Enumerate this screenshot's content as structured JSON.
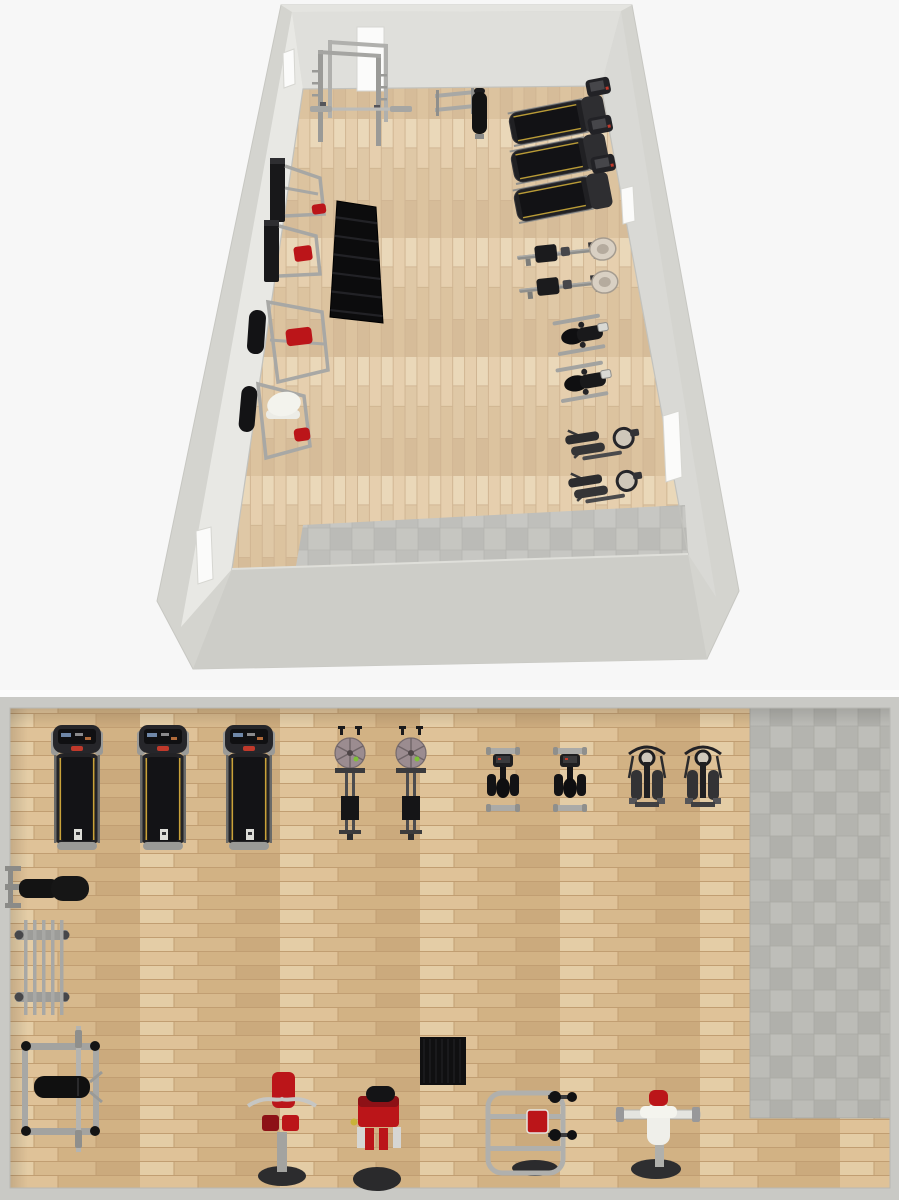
{
  "meta": {
    "title": "Gym floor plan - 3D perspective view and 2D top-down plan"
  },
  "palette": {
    "bg": "#f7f7f7",
    "wall_outer": "#d4d4cf",
    "wall_top": "#e4e4e0",
    "wall_back": "#dfdfdb",
    "wall_left": "#e8e8e4",
    "wall_right": "#d9d9d5",
    "wall_front": "#cdcdc8",
    "plan_wall": "#c9c9c5",
    "plan_gap": "#fbfbfb",
    "wood_base": "#d8b98c",
    "wood_seg1": "#dfc298",
    "wood_seg2": "#d2b284",
    "wood_seg3": "#e4cda6",
    "wood_seg4": "#d7b98d",
    "wood_seg5": "#cbaa7d",
    "wood_seam": "#c19e72",
    "tile_base": "#b6b6b1",
    "tile_a": "#bcbcb7",
    "tile_b": "#b0b0ab",
    "tile_c": "#b4b4af",
    "tile_d": "#bebeb9",
    "tile_line": "#a9a9a4",
    "equip_black": "#141416",
    "equip_dark": "#26262a",
    "equip_gray": "#9a9a97",
    "equip_lightgray": "#ababa8",
    "rail_dark": "#6b6b69",
    "red": "#bb1519",
    "red_dark": "#8d1116",
    "stop_red": "#c0392b",
    "yellow": "#c9a23a",
    "green": "#7fbf3a",
    "screen": "#3a3a3c",
    "white_part": "#efefea",
    "flywheel": "#9b8c90",
    "flywheel_rim": "#756a6d",
    "base_dark": "#2c2c2e",
    "door_white": "#fbfbfa"
  },
  "inventory": [
    {
      "label": "Treadmill",
      "count": 3
    },
    {
      "label": "Rowing machine",
      "count": 2
    },
    {
      "label": "Upright exercise bike",
      "count": 2
    },
    {
      "label": "Elliptical cross-trainer",
      "count": 2
    },
    {
      "label": "Power rack with barbell",
      "count": 1
    },
    {
      "label": "Barbell storage rack",
      "count": 1
    },
    {
      "label": "Adjustable bench",
      "count": 1
    },
    {
      "label": "Bench press station",
      "count": 1
    },
    {
      "label": "Dumbbell rack",
      "count": 1
    },
    {
      "label": "Rubber mat",
      "count": 1
    },
    {
      "label": "Preacher curl machine",
      "count": 1
    },
    {
      "label": "Red leg machine",
      "count": 1
    },
    {
      "label": "Seated press machine",
      "count": 1
    },
    {
      "label": "Pec deck machine",
      "count": 1
    },
    {
      "label": "Cable tower",
      "count": 2
    }
  ],
  "view3d": {
    "x": 0,
    "y": 0,
    "w": 899,
    "h": 690,
    "silhouette": [
      [
        281,
        5
      ],
      [
        632,
        5
      ],
      [
        739,
        591
      ],
      [
        707,
        659
      ],
      [
        193,
        669
      ],
      [
        157,
        601
      ]
    ],
    "top_band": [
      [
        281,
        5
      ],
      [
        632,
        5
      ],
      [
        621,
        11
      ],
      [
        292,
        12
      ]
    ],
    "back_wall": [
      [
        292,
        12
      ],
      [
        621,
        11
      ],
      [
        601,
        86
      ],
      [
        303,
        89
      ]
    ],
    "left_wall": [
      [
        292,
        12
      ],
      [
        303,
        89
      ],
      [
        232,
        569
      ],
      [
        181,
        627
      ]
    ],
    "right_wall": [
      [
        621,
        11
      ],
      [
        601,
        86
      ],
      [
        688,
        554
      ],
      [
        716,
        597
      ]
    ],
    "front_wall": [
      [
        232,
        569
      ],
      [
        688,
        554
      ],
      [
        707,
        659
      ],
      [
        193,
        669
      ]
    ],
    "floor": [
      [
        303,
        89
      ],
      [
        601,
        86
      ],
      [
        688,
        554
      ],
      [
        232,
        569
      ]
    ],
    "tile": [
      [
        303,
        525
      ],
      [
        685,
        505
      ],
      [
        688,
        554
      ],
      [
        296,
        566
      ]
    ],
    "openings": [
      {
        "name": "back-window",
        "pts": [
          [
            357,
            27
          ],
          [
            384,
            27
          ],
          [
            384,
            91
          ],
          [
            357,
            91
          ]
        ]
      },
      {
        "name": "left-window",
        "pts": [
          [
            283,
            53
          ],
          [
            294,
            49
          ],
          [
            295,
            84
          ],
          [
            284,
            88
          ]
        ]
      },
      {
        "name": "left-door",
        "pts": [
          [
            196,
            531
          ],
          [
            211,
            527
          ],
          [
            213,
            579
          ],
          [
            198,
            584
          ]
        ]
      },
      {
        "name": "right-window",
        "pts": [
          [
            621,
            189
          ],
          [
            633,
            186
          ],
          [
            635,
            221
          ],
          [
            623,
            224
          ]
        ]
      },
      {
        "name": "right-door",
        "pts": [
          [
            663,
            416
          ],
          [
            679,
            411
          ],
          [
            682,
            477
          ],
          [
            666,
            482
          ]
        ]
      }
    ],
    "equipment": [
      {
        "type": "power_rack",
        "x": 318,
        "y": 40
      },
      {
        "type": "bar_holder",
        "x": 435,
        "y": 88
      },
      {
        "type": "bench3d",
        "x": 472,
        "y": 92
      },
      {
        "type": "treadmill3d",
        "cx": 556,
        "cy": 121,
        "rot": -11
      },
      {
        "type": "treadmill3d",
        "cx": 558,
        "cy": 159,
        "rot": -11
      },
      {
        "type": "treadmill3d",
        "cx": 561,
        "cy": 198,
        "rot": -11
      },
      {
        "type": "rower3d",
        "cx": 565,
        "cy": 253,
        "rot": -6
      },
      {
        "type": "rower3d",
        "cx": 567,
        "cy": 286,
        "rot": -6
      },
      {
        "type": "bike3d",
        "cx": 581,
        "cy": 335,
        "rot": -10
      },
      {
        "type": "bike3d",
        "cx": 584,
        "cy": 382,
        "rot": -10
      },
      {
        "type": "elliptical3d",
        "cx": 598,
        "cy": 442,
        "rot": -9
      },
      {
        "type": "elliptical3d",
        "cx": 601,
        "cy": 485,
        "rot": -9
      },
      {
        "type": "cable_tower",
        "x": 270,
        "y": 158
      },
      {
        "type": "cable_tower_red",
        "x": 264,
        "y": 220
      },
      {
        "type": "dumbbell_rack3d",
        "pts": [
          [
            337,
            201
          ],
          [
            376,
            207
          ],
          [
            383,
            323
          ],
          [
            330,
            317
          ]
        ]
      },
      {
        "type": "press3d",
        "x": 248,
        "y": 300
      },
      {
        "type": "pec3d",
        "x": 238,
        "y": 384
      }
    ]
  },
  "plan2d": {
    "x": 0,
    "y": 690,
    "w": 899,
    "h": 510,
    "gap": {
      "x": 0,
      "y": 690,
      "w": 899,
      "h": 7
    },
    "wall_frame": {
      "x": 0,
      "y": 697,
      "w": 899,
      "h": 503
    },
    "floor": {
      "x": 10,
      "y": 708,
      "w": 880,
      "h": 480
    },
    "tile": {
      "x": 750,
      "y": 708,
      "w": 140,
      "h": 410
    },
    "equipment": [
      {
        "type": "treadmill",
        "x": 51,
        "y": 725
      },
      {
        "type": "treadmill",
        "x": 137,
        "y": 725
      },
      {
        "type": "treadmill",
        "x": 223,
        "y": 725
      },
      {
        "type": "rower",
        "x": 335,
        "y": 726
      },
      {
        "type": "rower",
        "x": 396,
        "y": 726
      },
      {
        "type": "bike",
        "x": 486,
        "y": 744
      },
      {
        "type": "bike",
        "x": 553,
        "y": 744
      },
      {
        "type": "elliptical",
        "x": 627,
        "y": 744
      },
      {
        "type": "elliptical",
        "x": 683,
        "y": 744
      },
      {
        "type": "bench",
        "x": 5,
        "y": 866
      },
      {
        "type": "barbell_rack",
        "x": 16,
        "y": 920
      },
      {
        "type": "bench_press",
        "x": 20,
        "y": 1026
      },
      {
        "type": "preacher_curl",
        "x": 246,
        "y": 1068
      },
      {
        "type": "leg_machine",
        "x": 352,
        "y": 1084
      },
      {
        "type": "mat",
        "x": 420,
        "y": 1037,
        "w": 46,
        "h": 48
      },
      {
        "type": "grip_machine",
        "x": 486,
        "y": 1090
      },
      {
        "type": "pec_deck",
        "x": 616,
        "y": 1088
      }
    ]
  }
}
